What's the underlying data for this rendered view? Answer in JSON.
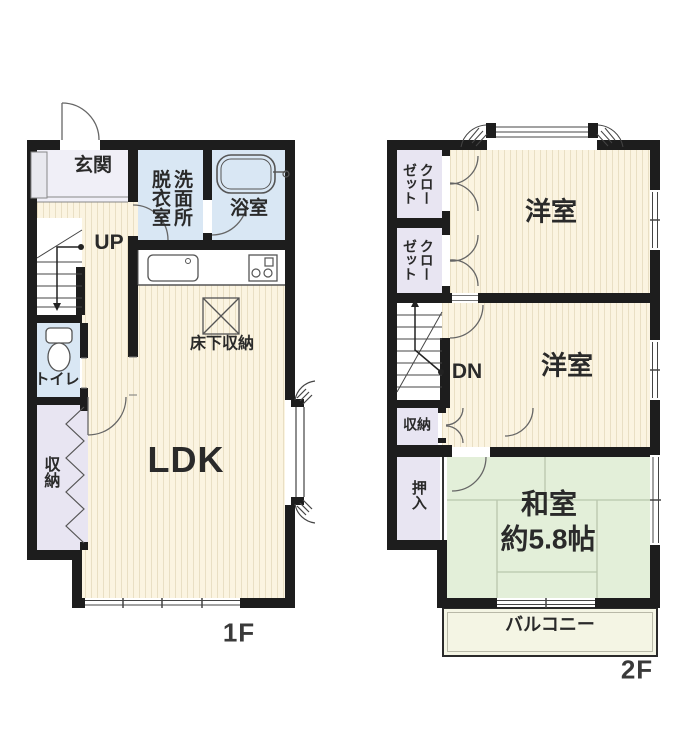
{
  "floor1": {
    "floor_label": "1F",
    "rooms": {
      "genkan": "玄関",
      "datsui_shitsu": "脱衣室",
      "senmenjo": "洗面所",
      "yokushitsu": "浴室",
      "stairs_up": "UP",
      "toilet": "トイレ",
      "storage": "収納",
      "ldk": "LDK",
      "underfloor_storage": "床下収納"
    }
  },
  "floor2": {
    "floor_label": "2F",
    "rooms": {
      "closet_col_left": "ゼット",
      "closet_col_right": "クロー",
      "western_room_1": "洋室",
      "western_room_2": "洋室",
      "stairs_down": "DN",
      "storage": "収納",
      "oshiire": "押入",
      "japanese_room": "和室",
      "japanese_room_size": "約5.8帖",
      "balcony": "バルコニー"
    }
  },
  "colors": {
    "wall": "#1d1d1d",
    "wood_floor": "#fbf4e1",
    "wet_area": "#d9e7f4",
    "storage_area": "#e8e5f2",
    "tatami": "#e3efd9",
    "balcony": "#f4f5e4"
  }
}
